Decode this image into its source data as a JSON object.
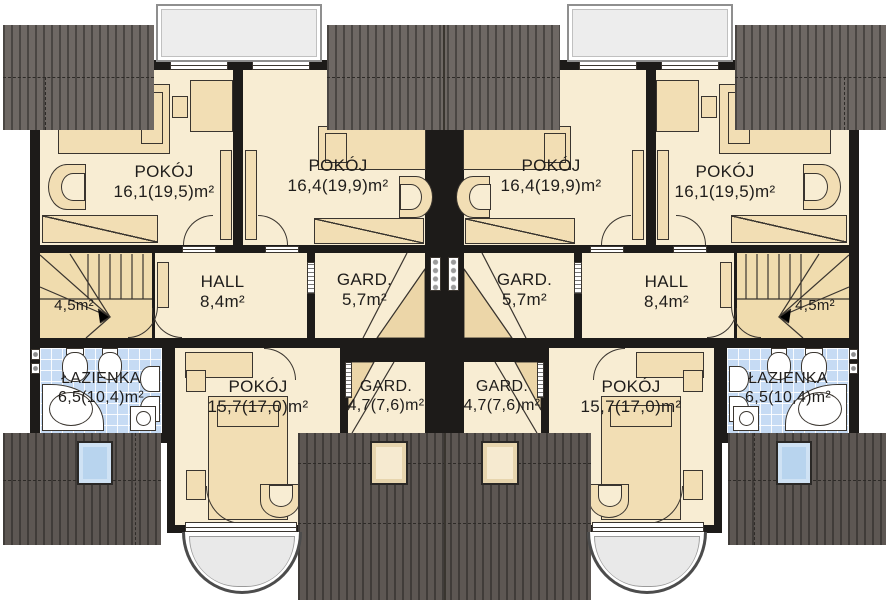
{
  "plan": {
    "colors": {
      "wall": "#1d1b19",
      "room": "#f8edd3",
      "furniture": "#f2deb4",
      "stairs_fill": "#f0dcae",
      "roof": "#6e6864",
      "roof_dark": "#5d5753",
      "bathroom_tile": "#c6dbf4",
      "dormer": "#ededed",
      "balcony": "#e9e9e9",
      "skylight_blue": "#b8d4ee"
    }
  },
  "rooms": {
    "left": {
      "pokoj_corner": {
        "name": "POKÓJ",
        "area": "16,1(19,5)m²"
      },
      "pokoj_center": {
        "name": "POKÓJ",
        "area": "16,4(19,9)m²"
      },
      "hall": {
        "name": "HALL",
        "area": "8,4m²"
      },
      "gard_upper": {
        "name": "GARD.",
        "area": "5,7m²"
      },
      "stairs": {
        "area": "4,5m²"
      },
      "bathroom": {
        "name": "ŁAZIENKA",
        "area": "6,5(10,4)m²"
      },
      "pokoj_lower": {
        "name": "POKÓJ",
        "area": "15,7(17,0)m²"
      },
      "gard_lower": {
        "name": "GARD.",
        "area": "4,7(7,6)m²"
      }
    },
    "right": {
      "pokoj_corner": {
        "name": "POKÓJ",
        "area": "16,1(19,5)m²"
      },
      "pokoj_center": {
        "name": "POKÓJ",
        "area": "16,4(19,9)m²"
      },
      "hall": {
        "name": "HALL",
        "area": "8,4m²"
      },
      "gard_upper": {
        "name": "GARD.",
        "area": "5,7m²"
      },
      "stairs": {
        "area": "4,5m²"
      },
      "bathroom": {
        "name": "ŁAZIENKA",
        "area": "6,5(10,4)m²"
      },
      "pokoj_lower": {
        "name": "POKÓJ",
        "area": "15,7(17,0)m²"
      },
      "gard_lower": {
        "name": "GARD.",
        "area": "4,7(7,6)m²"
      }
    }
  }
}
